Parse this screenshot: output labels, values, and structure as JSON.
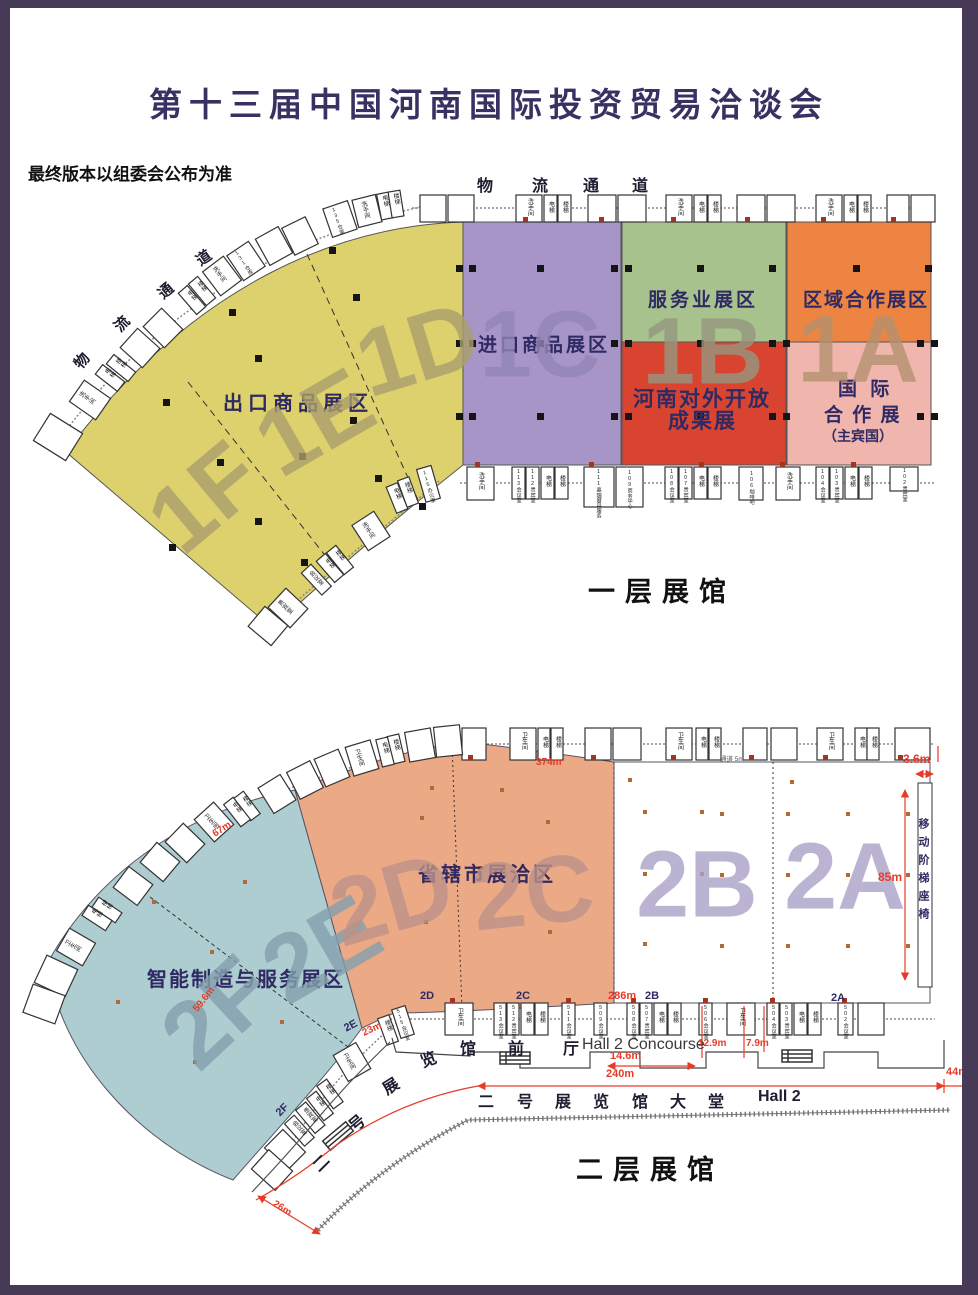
{
  "frame_color": "#473a56",
  "title": "第十三届中国河南国际投资贸易洽谈会",
  "disclaimer": "最终版本以组委会公布为准",
  "labels": {
    "washroom": "洗手间",
    "toilet": "卫生间",
    "elevator": "电梯",
    "stairs": "楼梯",
    "meeting": "会议室",
    "vip": "贵宾室"
  },
  "floor1": {
    "caption": "一层展馆",
    "logistics": [
      "物",
      "流",
      "通",
      "道"
    ],
    "zones": {
      "export": {
        "name": "出口商品展区",
        "big": [
          "1F",
          "1E",
          "1D"
        ],
        "color": "#dcd16d"
      },
      "import": {
        "name": "进口商品展区",
        "big": "1C",
        "color": "#a795c7"
      },
      "service": {
        "name": "服务业展区",
        "big": "1B",
        "color": "#a8c28e"
      },
      "opening": {
        "line1": "河南对外开放",
        "line2": "成果展",
        "color": "#d84430"
      },
      "regional": {
        "name": "区域合作展区",
        "big": "1A",
        "color": "#ee8441"
      },
      "international": {
        "line1": "国 际",
        "line2": "合 作 展",
        "line3": "（主宾国）",
        "color": "#f0b5ad"
      }
    },
    "rooms": {
      "store131": "131仓库",
      "store135": "135仓库",
      "office115": "115办公室",
      "bottom": [
        "洗手间",
        "113会议室",
        "112贵宾室",
        "电梯",
        "楼梯",
        "111嘉瑞展具服务",
        "109商务中心",
        "108会议室",
        "107贵宾室",
        "电梯",
        "楼梯",
        "106咖啡吧",
        "洗手间",
        "104会议室",
        "103贵宾室",
        "电梯",
        "楼梯",
        "102贵宾室"
      ]
    }
  },
  "floor2": {
    "caption": "二层展馆",
    "zones": {
      "smart": {
        "name": "智能制造与服务展区",
        "big": [
          "2F",
          "2E"
        ],
        "color": "#aecdd1"
      },
      "cities": {
        "name": "省辖市展洽区",
        "big": [
          "2D",
          "2C"
        ],
        "color": "#eca986"
      },
      "hallB": {
        "big": "2B"
      },
      "hallA": {
        "big": "2A"
      }
    },
    "seating": "移动阶梯座椅",
    "corridor_note": "通道 5m",
    "concourse": {
      "chars": [
        "馆",
        "前",
        "厅"
      ],
      "en": "Hall 2 Concourse",
      "curve": [
        "二",
        "号",
        "展",
        "览"
      ]
    },
    "lobby": {
      "chars": [
        "二",
        "号",
        "展",
        "览",
        "馆",
        "大",
        "堂"
      ],
      "en": "Hall 2"
    },
    "meas": {
      "m374": "374m",
      "m36": "3.6m",
      "m85": "85m",
      "m286": "286m",
      "m129": "12.9m",
      "m79": "7.9m",
      "m146": "14.6m",
      "m240": "240m",
      "m44": "44m",
      "m26": "26m",
      "m67": "67m",
      "m596": "59.6m",
      "m23": "23m"
    },
    "edge": {
      "d": "2D",
      "c": "2C",
      "b": "2B",
      "a": "2A",
      "e": "2E",
      "f": "2F"
    },
    "rooms": {
      "bottom": [
        "卫生间",
        "513会议室",
        "512贵宾室",
        "电梯",
        "楼梯",
        "511会议室",
        "509会议室",
        "508会议室",
        "507贵宾室",
        "电梯",
        "楼梯",
        "506会议室",
        "卫生间",
        "504会议室",
        "503贵宾室",
        "电梯",
        "楼梯",
        "502会议室",
        "515会议室"
      ]
    }
  }
}
